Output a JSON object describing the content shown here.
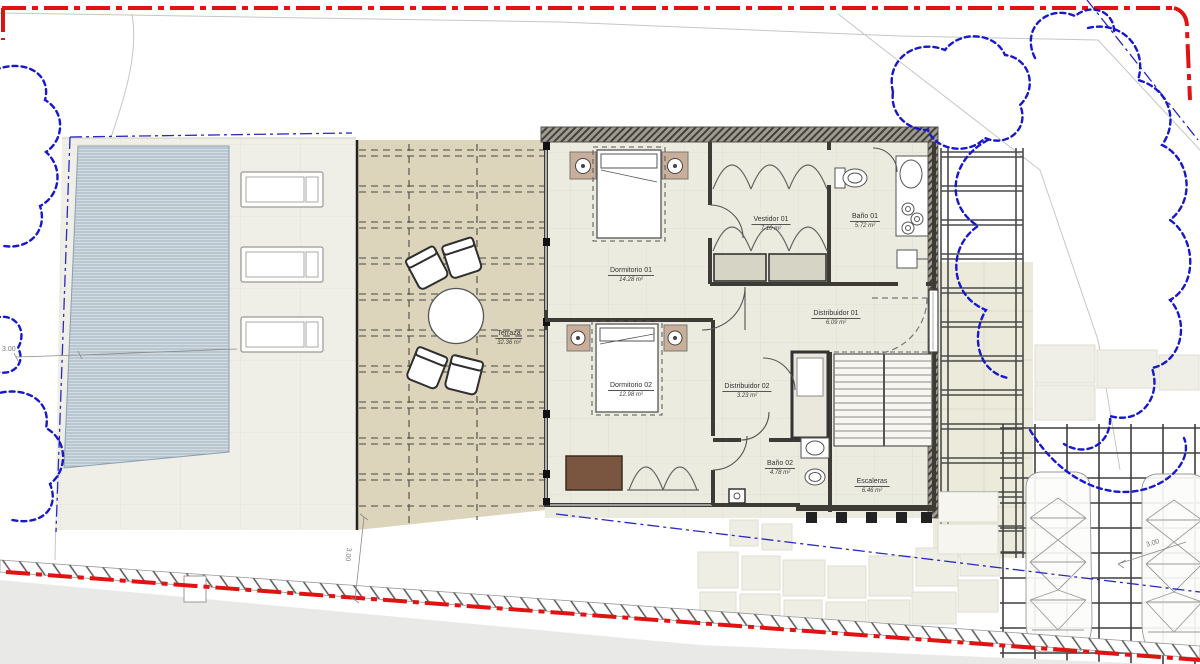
{
  "plan": {
    "rooms": [
      {
        "id": "terraza",
        "name": "Terraza",
        "area": "32.36 m²"
      },
      {
        "id": "dormitorio-01",
        "name": "Dormitorio 01",
        "area": "14.28 m²"
      },
      {
        "id": "vestidor-01",
        "name": "Vestidor 01",
        "area": "7.10 m²"
      },
      {
        "id": "bano-01",
        "name": "Baño 01",
        "area": "5.72 m²"
      },
      {
        "id": "distribuidor-01",
        "name": "Distribuidor 01",
        "area": "6.09 m²"
      },
      {
        "id": "dormitorio-02",
        "name": "Dormitorio 02",
        "area": "12.98 m²"
      },
      {
        "id": "distribuidor-02",
        "name": "Distribuidor 02",
        "area": "3.23 m²"
      },
      {
        "id": "bano-02",
        "name": "Baño 02",
        "area": "4.78 m²"
      },
      {
        "id": "escaleras",
        "name": "Escaleras",
        "area": "6.46 m²"
      }
    ],
    "dimensions": {
      "west_setback": "3.00",
      "south_setback": "3.00",
      "east_setback": "3.00"
    },
    "colors": {
      "boundary_red": "#e11212",
      "vegetation_blue": "#1717cd",
      "setback_blue": "#2a2abf",
      "terrace_tan": "#dcd4bb",
      "floor_beige": "#ecebdf",
      "pool_blue": "#d3dce2",
      "wall_dark": "#3e3b36"
    }
  }
}
